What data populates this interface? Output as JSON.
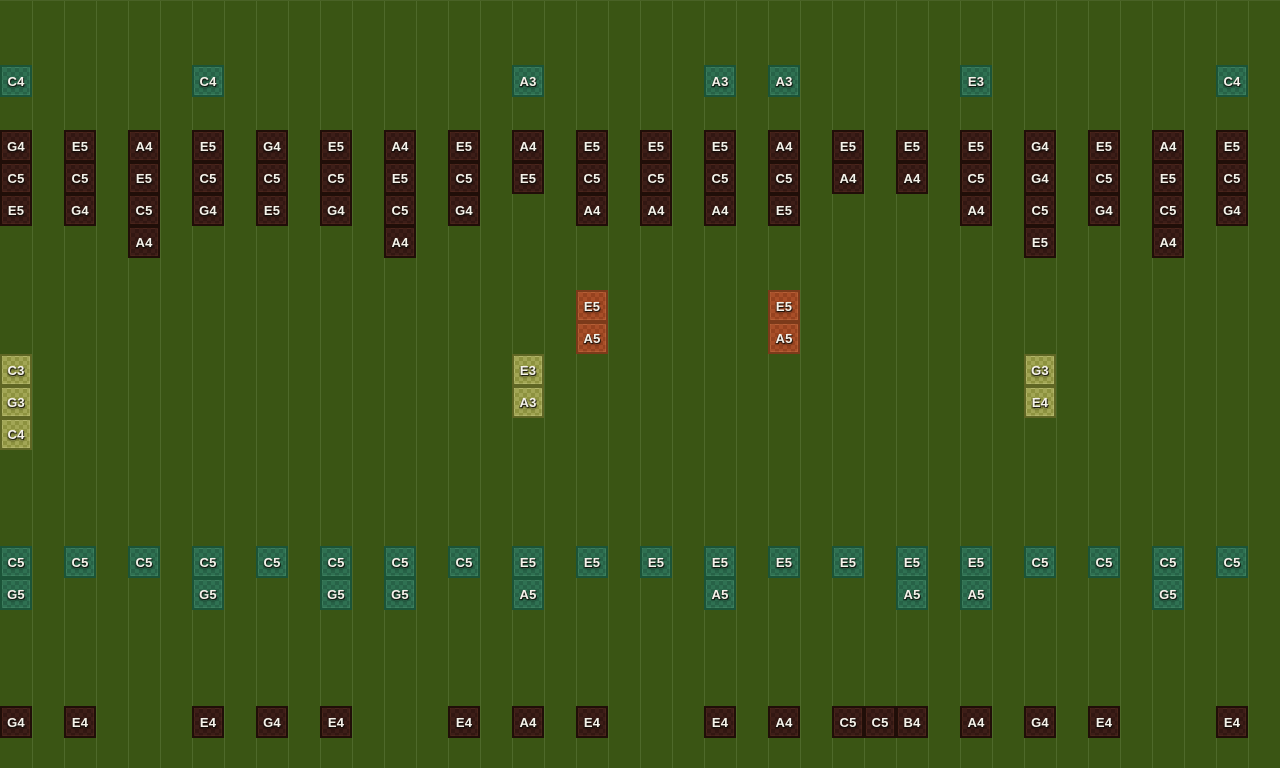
{
  "app": {
    "name": "note-block-sequencer-grid"
  },
  "grid": {
    "width": 1280,
    "height": 768,
    "line_spacing": 32,
    "column_spacing": 64,
    "cell_size": 32
  },
  "palette": {
    "background": "#3a5514",
    "gridline": "#5e7a3c",
    "label_text": "#f5f2ea",
    "green_border": "#1b5438",
    "green_fill_a": "#2f7152",
    "green_fill_b": "#276247",
    "dark_border": "#200e08",
    "dark_fill_a": "#3d1e18",
    "dark_fill_b": "#321712",
    "orange_border": "#7c3a1a",
    "orange_fill_a": "#a84e28",
    "orange_fill_b": "#96421f",
    "olive_border": "#5f6624",
    "olive_fill_a": "#a2a655",
    "olive_fill_b": "#8d923f"
  },
  "notes": [
    {
      "x": 0,
      "y": 64,
      "label": "C4",
      "style": "green"
    },
    {
      "x": 192,
      "y": 64,
      "label": "C4",
      "style": "green"
    },
    {
      "x": 512,
      "y": 64,
      "label": "A3",
      "style": "green"
    },
    {
      "x": 704,
      "y": 64,
      "label": "A3",
      "style": "green"
    },
    {
      "x": 768,
      "y": 64,
      "label": "A3",
      "style": "green"
    },
    {
      "x": 960,
      "y": 64,
      "label": "E3",
      "style": "green"
    },
    {
      "x": 1216,
      "y": 64,
      "label": "C4",
      "style": "green"
    },
    {
      "x": 0,
      "y": 129,
      "label": "G4",
      "style": "dark"
    },
    {
      "x": 0,
      "y": 161,
      "label": "C5",
      "style": "dark"
    },
    {
      "x": 0,
      "y": 193,
      "label": "E5",
      "style": "dark"
    },
    {
      "x": 64,
      "y": 129,
      "label": "E5",
      "style": "dark"
    },
    {
      "x": 64,
      "y": 161,
      "label": "C5",
      "style": "dark"
    },
    {
      "x": 64,
      "y": 193,
      "label": "G4",
      "style": "dark"
    },
    {
      "x": 128,
      "y": 129,
      "label": "A4",
      "style": "dark"
    },
    {
      "x": 128,
      "y": 161,
      "label": "E5",
      "style": "dark"
    },
    {
      "x": 128,
      "y": 193,
      "label": "C5",
      "style": "dark"
    },
    {
      "x": 128,
      "y": 225,
      "label": "A4",
      "style": "dark"
    },
    {
      "x": 192,
      "y": 129,
      "label": "E5",
      "style": "dark"
    },
    {
      "x": 192,
      "y": 161,
      "label": "C5",
      "style": "dark"
    },
    {
      "x": 192,
      "y": 193,
      "label": "G4",
      "style": "dark"
    },
    {
      "x": 256,
      "y": 129,
      "label": "G4",
      "style": "dark"
    },
    {
      "x": 256,
      "y": 161,
      "label": "C5",
      "style": "dark"
    },
    {
      "x": 256,
      "y": 193,
      "label": "E5",
      "style": "dark"
    },
    {
      "x": 320,
      "y": 129,
      "label": "E5",
      "style": "dark"
    },
    {
      "x": 320,
      "y": 161,
      "label": "C5",
      "style": "dark"
    },
    {
      "x": 320,
      "y": 193,
      "label": "G4",
      "style": "dark"
    },
    {
      "x": 384,
      "y": 129,
      "label": "A4",
      "style": "dark"
    },
    {
      "x": 384,
      "y": 161,
      "label": "E5",
      "style": "dark"
    },
    {
      "x": 384,
      "y": 193,
      "label": "C5",
      "style": "dark"
    },
    {
      "x": 384,
      "y": 225,
      "label": "A4",
      "style": "dark"
    },
    {
      "x": 448,
      "y": 129,
      "label": "E5",
      "style": "dark"
    },
    {
      "x": 448,
      "y": 161,
      "label": "C5",
      "style": "dark"
    },
    {
      "x": 448,
      "y": 193,
      "label": "G4",
      "style": "dark"
    },
    {
      "x": 512,
      "y": 129,
      "label": "A4",
      "style": "dark"
    },
    {
      "x": 512,
      "y": 161,
      "label": "E5",
      "style": "dark"
    },
    {
      "x": 576,
      "y": 129,
      "label": "E5",
      "style": "dark"
    },
    {
      "x": 576,
      "y": 161,
      "label": "C5",
      "style": "dark"
    },
    {
      "x": 576,
      "y": 193,
      "label": "A4",
      "style": "dark"
    },
    {
      "x": 640,
      "y": 129,
      "label": "E5",
      "style": "dark"
    },
    {
      "x": 640,
      "y": 161,
      "label": "C5",
      "style": "dark"
    },
    {
      "x": 640,
      "y": 193,
      "label": "A4",
      "style": "dark"
    },
    {
      "x": 704,
      "y": 129,
      "label": "E5",
      "style": "dark"
    },
    {
      "x": 704,
      "y": 161,
      "label": "C5",
      "style": "dark"
    },
    {
      "x": 704,
      "y": 193,
      "label": "A4",
      "style": "dark"
    },
    {
      "x": 768,
      "y": 129,
      "label": "A4",
      "style": "dark"
    },
    {
      "x": 768,
      "y": 161,
      "label": "C5",
      "style": "dark"
    },
    {
      "x": 768,
      "y": 193,
      "label": "E5",
      "style": "dark"
    },
    {
      "x": 832,
      "y": 129,
      "label": "E5",
      "style": "dark"
    },
    {
      "x": 832,
      "y": 161,
      "label": "A4",
      "style": "dark"
    },
    {
      "x": 896,
      "y": 129,
      "label": "E5",
      "style": "dark"
    },
    {
      "x": 896,
      "y": 161,
      "label": "A4",
      "style": "dark"
    },
    {
      "x": 960,
      "y": 129,
      "label": "E5",
      "style": "dark"
    },
    {
      "x": 960,
      "y": 161,
      "label": "C5",
      "style": "dark"
    },
    {
      "x": 960,
      "y": 193,
      "label": "A4",
      "style": "dark"
    },
    {
      "x": 1024,
      "y": 129,
      "label": "G4",
      "style": "dark"
    },
    {
      "x": 1024,
      "y": 161,
      "label": "G4",
      "style": "dark"
    },
    {
      "x": 1024,
      "y": 193,
      "label": "C5",
      "style": "dark"
    },
    {
      "x": 1024,
      "y": 225,
      "label": "E5",
      "style": "dark"
    },
    {
      "x": 1088,
      "y": 129,
      "label": "E5",
      "style": "dark"
    },
    {
      "x": 1088,
      "y": 161,
      "label": "C5",
      "style": "dark"
    },
    {
      "x": 1088,
      "y": 193,
      "label": "G4",
      "style": "dark"
    },
    {
      "x": 1152,
      "y": 129,
      "label": "A4",
      "style": "dark"
    },
    {
      "x": 1152,
      "y": 161,
      "label": "E5",
      "style": "dark"
    },
    {
      "x": 1152,
      "y": 193,
      "label": "C5",
      "style": "dark"
    },
    {
      "x": 1152,
      "y": 225,
      "label": "A4",
      "style": "dark"
    },
    {
      "x": 1216,
      "y": 129,
      "label": "E5",
      "style": "dark"
    },
    {
      "x": 1216,
      "y": 161,
      "label": "C5",
      "style": "dark"
    },
    {
      "x": 1216,
      "y": 193,
      "label": "G4",
      "style": "dark"
    },
    {
      "x": 576,
      "y": 289,
      "label": "E5",
      "style": "orange"
    },
    {
      "x": 576,
      "y": 321,
      "label": "A5",
      "style": "orange"
    },
    {
      "x": 768,
      "y": 289,
      "label": "E5",
      "style": "orange"
    },
    {
      "x": 768,
      "y": 321,
      "label": "A5",
      "style": "orange"
    },
    {
      "x": 0,
      "y": 353,
      "label": "C3",
      "style": "olive"
    },
    {
      "x": 0,
      "y": 385,
      "label": "G3",
      "style": "olive"
    },
    {
      "x": 0,
      "y": 417,
      "label": "C4",
      "style": "olive"
    },
    {
      "x": 512,
      "y": 353,
      "label": "E3",
      "style": "olive"
    },
    {
      "x": 512,
      "y": 385,
      "label": "A3",
      "style": "olive"
    },
    {
      "x": 1024,
      "y": 353,
      "label": "G3",
      "style": "olive"
    },
    {
      "x": 1024,
      "y": 385,
      "label": "E4",
      "style": "olive"
    },
    {
      "x": 0,
      "y": 545,
      "label": "C5",
      "style": "green"
    },
    {
      "x": 0,
      "y": 577,
      "label": "G5",
      "style": "green"
    },
    {
      "x": 64,
      "y": 545,
      "label": "C5",
      "style": "green"
    },
    {
      "x": 128,
      "y": 545,
      "label": "C5",
      "style": "green"
    },
    {
      "x": 192,
      "y": 545,
      "label": "C5",
      "style": "green"
    },
    {
      "x": 192,
      "y": 577,
      "label": "G5",
      "style": "green"
    },
    {
      "x": 256,
      "y": 545,
      "label": "C5",
      "style": "green"
    },
    {
      "x": 320,
      "y": 545,
      "label": "C5",
      "style": "green"
    },
    {
      "x": 320,
      "y": 577,
      "label": "G5",
      "style": "green"
    },
    {
      "x": 384,
      "y": 545,
      "label": "C5",
      "style": "green"
    },
    {
      "x": 384,
      "y": 577,
      "label": "G5",
      "style": "green"
    },
    {
      "x": 448,
      "y": 545,
      "label": "C5",
      "style": "green"
    },
    {
      "x": 512,
      "y": 545,
      "label": "E5",
      "style": "green"
    },
    {
      "x": 512,
      "y": 577,
      "label": "A5",
      "style": "green"
    },
    {
      "x": 576,
      "y": 545,
      "label": "E5",
      "style": "green"
    },
    {
      "x": 640,
      "y": 545,
      "label": "E5",
      "style": "green"
    },
    {
      "x": 704,
      "y": 545,
      "label": "E5",
      "style": "green"
    },
    {
      "x": 704,
      "y": 577,
      "label": "A5",
      "style": "green"
    },
    {
      "x": 768,
      "y": 545,
      "label": "E5",
      "style": "green"
    },
    {
      "x": 832,
      "y": 545,
      "label": "E5",
      "style": "green"
    },
    {
      "x": 896,
      "y": 545,
      "label": "E5",
      "style": "green"
    },
    {
      "x": 896,
      "y": 577,
      "label": "A5",
      "style": "green"
    },
    {
      "x": 960,
      "y": 545,
      "label": "E5",
      "style": "green"
    },
    {
      "x": 960,
      "y": 577,
      "label": "A5",
      "style": "green"
    },
    {
      "x": 1024,
      "y": 545,
      "label": "C5",
      "style": "green"
    },
    {
      "x": 1088,
      "y": 545,
      "label": "C5",
      "style": "green"
    },
    {
      "x": 1152,
      "y": 545,
      "label": "C5",
      "style": "green"
    },
    {
      "x": 1152,
      "y": 577,
      "label": "G5",
      "style": "green"
    },
    {
      "x": 1216,
      "y": 545,
      "label": "C5",
      "style": "green"
    },
    {
      "x": 0,
      "y": 705,
      "label": "G4",
      "style": "dark"
    },
    {
      "x": 64,
      "y": 705,
      "label": "E4",
      "style": "dark"
    },
    {
      "x": 192,
      "y": 705,
      "label": "E4",
      "style": "dark"
    },
    {
      "x": 256,
      "y": 705,
      "label": "G4",
      "style": "dark"
    },
    {
      "x": 320,
      "y": 705,
      "label": "E4",
      "style": "dark"
    },
    {
      "x": 448,
      "y": 705,
      "label": "E4",
      "style": "dark"
    },
    {
      "x": 512,
      "y": 705,
      "label": "A4",
      "style": "dark"
    },
    {
      "x": 576,
      "y": 705,
      "label": "E4",
      "style": "dark"
    },
    {
      "x": 704,
      "y": 705,
      "label": "E4",
      "style": "dark"
    },
    {
      "x": 768,
      "y": 705,
      "label": "A4",
      "style": "dark"
    },
    {
      "x": 832,
      "y": 705,
      "label": "C5",
      "style": "dark"
    },
    {
      "x": 864,
      "y": 705,
      "label": "C5",
      "style": "dark"
    },
    {
      "x": 896,
      "y": 705,
      "label": "B4",
      "style": "dark"
    },
    {
      "x": 960,
      "y": 705,
      "label": "A4",
      "style": "dark"
    },
    {
      "x": 1024,
      "y": 705,
      "label": "G4",
      "style": "dark"
    },
    {
      "x": 1088,
      "y": 705,
      "label": "E4",
      "style": "dark"
    },
    {
      "x": 1216,
      "y": 705,
      "label": "E4",
      "style": "dark"
    }
  ]
}
